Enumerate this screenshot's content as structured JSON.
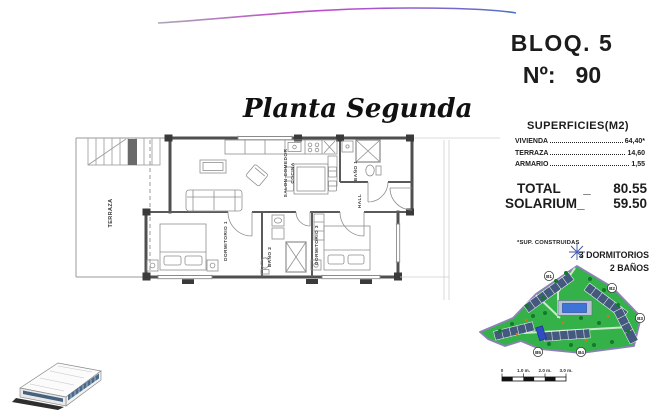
{
  "header": {
    "block_label": "BLOQ. 5",
    "number_label": "Nº:",
    "number_value": "90"
  },
  "plan": {
    "title": "Planta Segunda",
    "rooms": {
      "terraza": "TERRAZA",
      "salon_line1": "SALON-COMEDOR",
      "salon_line2": "COCINA",
      "bano1": "BAÑO 1",
      "hall": "HALL",
      "dormitorio1": "DORMITORIO 1",
      "bano2": "BAÑO 2",
      "dormitorio3": "DORMITORIO 3"
    }
  },
  "superficies": {
    "title": "SUPERFICIES(M2)",
    "rows": [
      {
        "label": "VIVIENDA",
        "value": "64,40*"
      },
      {
        "label": "TERRAZA",
        "value": "14,60"
      },
      {
        "label": "ARMARIO",
        "value": "1,55"
      }
    ],
    "total_label": "TOTAL",
    "total_sep": "_",
    "total_value": "80.55",
    "solarium_label": "SOLARIUM_",
    "solarium_value": "59.50",
    "footnote": "*SUP. CONSTRUIDAS",
    "features": [
      "3 DORMITORIOS",
      "2 BAÑOS"
    ]
  },
  "site_plan": {
    "block_labels": [
      "B1",
      "B2",
      "B3",
      "B4",
      "B5"
    ],
    "colors": {
      "grass": "#35b149",
      "border": "#8d80b8",
      "building": "#44597e",
      "pool": "#3e74d8",
      "highlight": "#2f4cc4"
    }
  },
  "scale_bar": {
    "ticks": [
      "0",
      "1.0 m.",
      "2.0 m.",
      "3.0 m."
    ]
  },
  "colors": {
    "footer_line": "#1f4e8c",
    "curve_magenta": "#c04fc8",
    "curve_blue": "#4d74c4"
  }
}
